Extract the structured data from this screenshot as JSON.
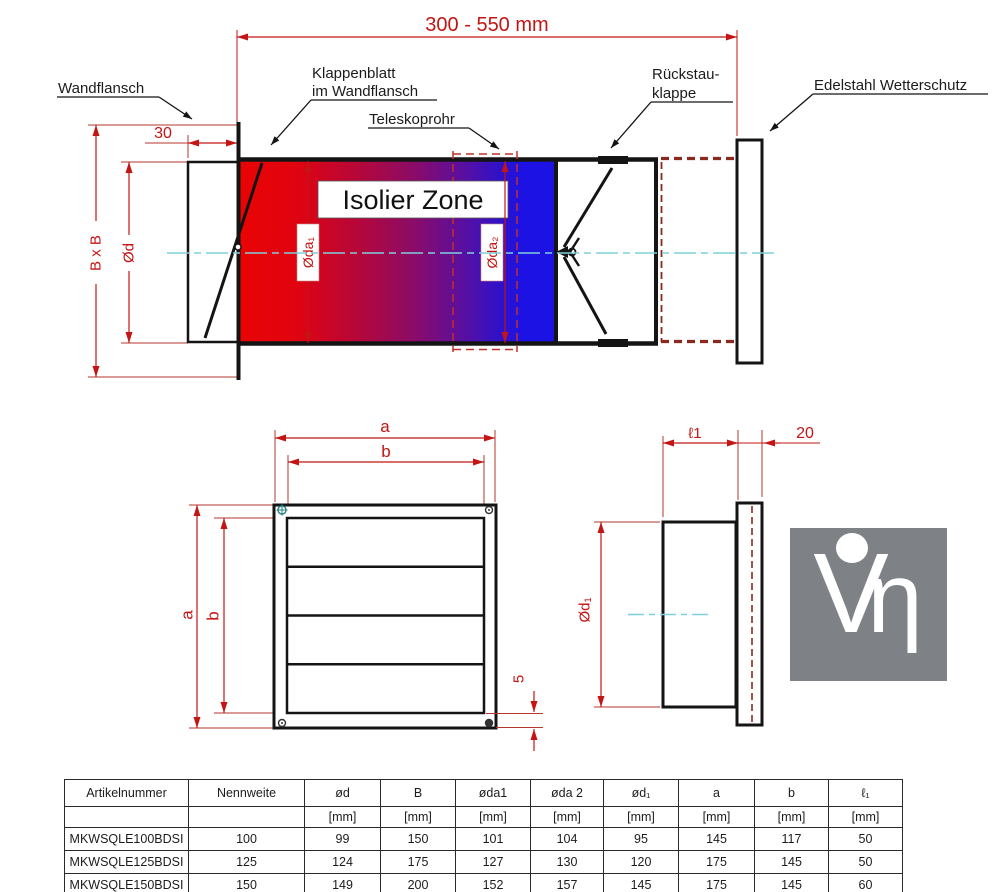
{
  "drawing": {
    "top_dim_label": "300 - 550 mm",
    "labels": {
      "wandflansch": "Wandflansch",
      "klappenblatt_line1": "Klappenblatt",
      "klappenblatt_line2": "im Wandflansch",
      "teleskoprohr": "Teleskoprohr",
      "rueckstau_line1": "Rückstau-",
      "rueckstau_line2": "klappe",
      "wetterschutz": "Edelstahl Wetterschutz",
      "isolier_zone": "Isolier Zone"
    },
    "dimensions": {
      "flansch_depth": "30",
      "duct_square": "B x B",
      "duct_dia": "Ød",
      "tube_dia1": "Øda₁",
      "tube_dia2": "Øda₂",
      "grille_a_top": "a",
      "grille_b_top": "b",
      "grille_a_left": "a",
      "grille_b_left": "b",
      "frame_edge": "5",
      "stub_length": "ℓ1",
      "plate_offset": "20",
      "stub_dia": "Ød₁"
    },
    "colors": {
      "dimension_red": "#c41414",
      "hidden_dashed_red": "#8a2a1e",
      "centerline_cyan": "#7fd0dc",
      "gradient_hot": "#e90404",
      "gradient_cold": "#1c12e4",
      "logo_gray": "#7e8286"
    }
  },
  "logo": {
    "letter_v": "V",
    "letter_eta": "η"
  },
  "table": {
    "columns": [
      "Artikelnummer",
      "Nennweite",
      "ød",
      "B",
      "øda1",
      "øda 2",
      "ød₁",
      "a",
      "b",
      "ℓ₁"
    ],
    "units": [
      "",
      "",
      "[mm]",
      "[mm]",
      "[mm]",
      "[mm]",
      "[mm]",
      "[mm]",
      "[mm]",
      "[mm]"
    ],
    "rows": [
      [
        "MKWSQLE100BDSI",
        "100",
        "99",
        "150",
        "101",
        "104",
        "95",
        "145",
        "117",
        "50"
      ],
      [
        "MKWSQLE125BDSI",
        "125",
        "124",
        "175",
        "127",
        "130",
        "120",
        "175",
        "145",
        "50"
      ],
      [
        "MKWSQLE150BDSI",
        "150",
        "149",
        "200",
        "152",
        "157",
        "145",
        "175",
        "145",
        "60"
      ]
    ]
  }
}
